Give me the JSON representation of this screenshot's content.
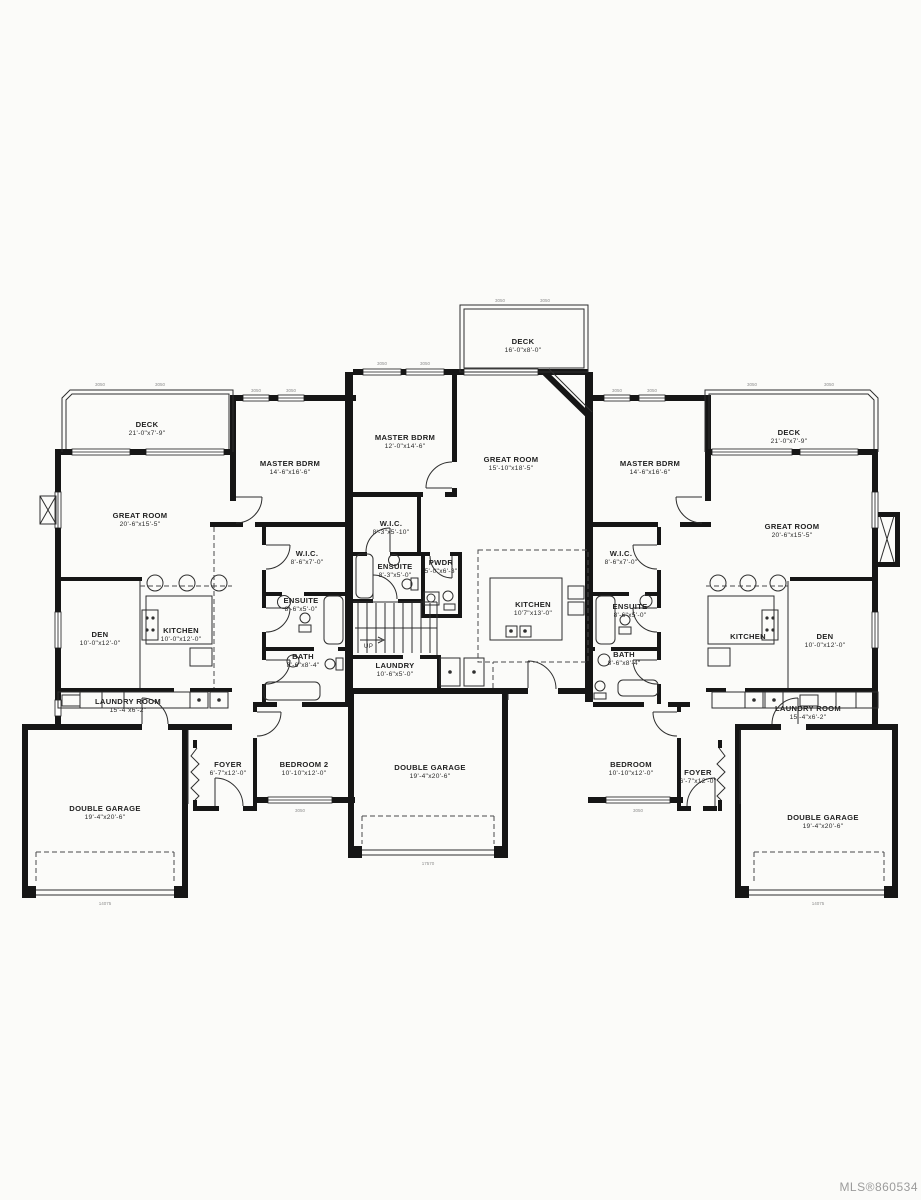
{
  "page": {
    "mls_label": "MLS®860534",
    "paper_color": "#fbfbf9",
    "line_color": "#161616"
  },
  "plan": {
    "stairs_up_label": "UP",
    "window_code": "3050",
    "plate_left": "14075",
    "plate_mid": "17570",
    "plate_right": "14075"
  },
  "rooms": {
    "l_deck": {
      "name": "DECK",
      "dims": "21'-0\"x7'-9\""
    },
    "l_great": {
      "name": "GREAT ROOM",
      "dims": "20'-6\"x15'-5\""
    },
    "l_master": {
      "name": "MASTER BDRM",
      "dims": "14'-6\"x16'-6\""
    },
    "l_wic": {
      "name": "W.I.C.",
      "dims": "8'-6\"x7'-0\""
    },
    "l_ensuite": {
      "name": "ENSUITE",
      "dims": "8'-6\"x5'-0\""
    },
    "l_bath": {
      "name": "BATH",
      "dims": "8'-6\"x8'-4\""
    },
    "l_den": {
      "name": "DEN",
      "dims": "10'-0\"x12'-0\""
    },
    "l_kitchen": {
      "name": "KITCHEN",
      "dims": "10'-0\"x12'-0\""
    },
    "l_laundry": {
      "name": "LAUNDRY ROOM",
      "dims": "15'-4\"x6'-2\""
    },
    "l_foyer": {
      "name": "FOYER",
      "dims": "6'-7\"x12'-0\""
    },
    "l_bed2": {
      "name": "BEDROOM 2",
      "dims": "10'-10\"x12'-0\""
    },
    "l_garage": {
      "name": "DOUBLE GARAGE",
      "dims": "19'-4\"x20'-6\""
    },
    "m_deck": {
      "name": "DECK",
      "dims": "16'-0\"x8'-0\""
    },
    "m_master": {
      "name": "MASTER BDRM",
      "dims": "12'-0\"x14'-6\""
    },
    "m_great": {
      "name": "GREAT ROOM",
      "dims": "15'-10\"x18'-5\""
    },
    "m_wic": {
      "name": "W.I.C.",
      "dims": "8'-3\"x5'-10\""
    },
    "m_ensuite": {
      "name": "ENSUITE",
      "dims": "8'-3\"x5'-0\""
    },
    "m_pwdr": {
      "name": "PWDR",
      "dims": "5'-0\"x6'-3\""
    },
    "m_kitchen": {
      "name": "KITCHEN",
      "dims": "10'7\"x13'-0\""
    },
    "m_laundry": {
      "name": "LAUNDRY",
      "dims": "10'-6\"x5'-0\""
    },
    "m_garage": {
      "name": "DOUBLE GARAGE",
      "dims": "19'-4\"x20'-6\""
    },
    "r_deck": {
      "name": "DECK",
      "dims": "21'-0\"x7'-9\""
    },
    "r_master": {
      "name": "MASTER BDRM",
      "dims": "14'-6\"x16'-6\""
    },
    "r_wic": {
      "name": "W.I.C.",
      "dims": "8'-6\"x7'-0\""
    },
    "r_ensuite": {
      "name": "ENSUITE",
      "dims": "8'-6\"x5'-0\""
    },
    "r_bath": {
      "name": "BATH",
      "dims": "8'-6\"x8'-4\""
    },
    "r_great": {
      "name": "GREAT ROOM",
      "dims": "20'-6\"x15'-5\""
    },
    "r_kitchen": {
      "name": "KITCHEN",
      "dims": ""
    },
    "r_den": {
      "name": "DEN",
      "dims": "10'-0\"x12'-0\""
    },
    "r_laundry": {
      "name": "LAUNDRY ROOM",
      "dims": "15'-4\"x6'-2\""
    },
    "r_bedroom": {
      "name": "BEDROOM",
      "dims": "10'-10\"x12'-0\""
    },
    "r_foyer": {
      "name": "FOYER",
      "dims": "6'-7\"x12'-0\""
    },
    "r_garage": {
      "name": "DOUBLE GARAGE",
      "dims": "19'-4\"x20'-6\""
    }
  }
}
